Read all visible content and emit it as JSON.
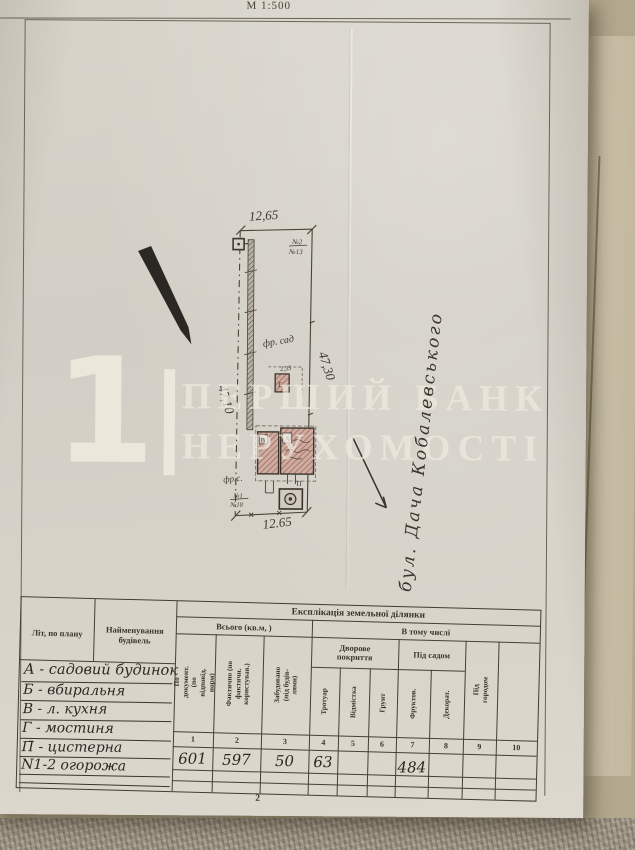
{
  "header": {
    "scale": "М 1:500"
  },
  "plan": {
    "dim_top": "12,65",
    "dim_bottom": "12.65",
    "dim_left": "47,10",
    "dim_right": "47,30",
    "plot_no_top": "№2",
    "plot_no_top_sub": "№13",
    "plot_no_bottom": "№1",
    "plot_no_bottom_sub": "№18",
    "garden_label": "фр. сад",
    "garden_label_short": "фр.с.",
    "porch_dim": "2,35",
    "bldg_main": "А",
    "bldg_shed": "Б",
    "bldg_kitchen": "В",
    "bldg_cistern": "П",
    "street_note": "бул. Дача Кобалевського"
  },
  "watermark": {
    "digit": "1",
    "line1": "ПЕРШИЙ БАНК",
    "line2": "НЕРУХОМОСТІ"
  },
  "table": {
    "title": "Експлікація земельної ділянки",
    "col_lit": "Літ, по плану",
    "col_name": "Найменування будівель",
    "group_total": "Всього (кв.м, )",
    "group_incl": "В тому числі",
    "group_yard": "Дворове покриття",
    "group_sad": "Під садом",
    "rot_cols": [
      "По документ. (по відповід. норм)",
      "Фактично (по фактичн. користував.)",
      "Забудовано (під будів-лями)",
      "Тротуар",
      "Відмістка",
      "Грунт",
      "Фруктов.",
      "Декорат.",
      "Під городом",
      ""
    ],
    "col_nums": [
      "1",
      "2",
      "3",
      "4",
      "5",
      "6",
      "7",
      "8",
      "9",
      "10"
    ],
    "entries": [
      "А - садовий будинок",
      "Б - вбиральня",
      "В - л. кухня",
      "Г - мостиня",
      "П̄ - цистерна",
      "N1-2 огорожа"
    ],
    "values": [
      "601",
      "597",
      "50",
      "63",
      "",
      "",
      "484",
      "",
      "",
      ""
    ],
    "page_number": "2"
  }
}
